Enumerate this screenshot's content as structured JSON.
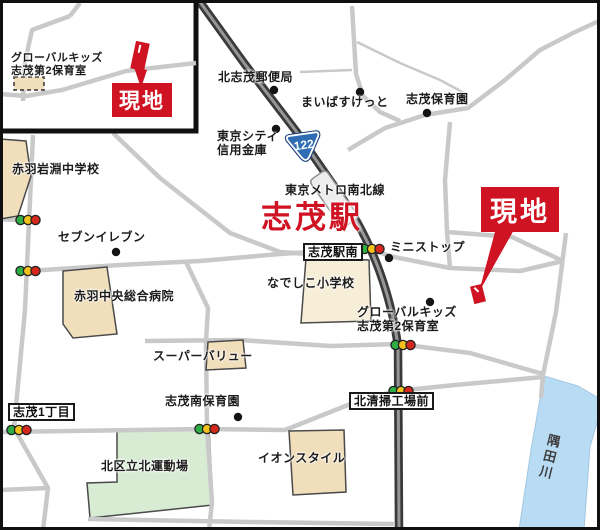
{
  "colors": {
    "accent-red": "#cf1322",
    "road-gray": "#c9c9c9",
    "rail-dark": "#3a3a3a",
    "rail-core": "#969696",
    "building-tan": "#f1deba",
    "building-cream": "#f7eed8",
    "park-green": "#d8ebd3",
    "river-blue": "#b9dcf5",
    "badge-blue": "#2f6cb3",
    "signal-green": "#2fae44",
    "signal-yellow": "#f3c11b",
    "signal-red": "#d4281c"
  },
  "station": {
    "line": "東京メトロ南北線",
    "name": "志茂駅"
  },
  "route": {
    "number": "122"
  },
  "site": {
    "label": "現地"
  },
  "river": {
    "name": "隅田川"
  },
  "pois": {
    "junior_high": "赤羽岩淵中学校",
    "post_office": "北志茂郵便局",
    "maibasuketto": "まいばすけっと",
    "shimo_nursery": "志茂保育園",
    "shinkin_line1": "東京シティ",
    "shinkin_line2": "信用金庫",
    "seven_eleven": "セブンイレブン",
    "ministop": "ミニストップ",
    "hospital": "赤羽中央総合病院",
    "elementary": "なでしこ小学校",
    "global_kids_line1": "グローバルキッズ",
    "global_kids_line2": "志茂第2保育室",
    "super_value": "スーパーバリュー",
    "minami_nursery": "志茂南保育園",
    "sports_ground": "北区立北運動場",
    "aeon_style": "イオンスタイル"
  },
  "signs": {
    "shimo_1chome": "志茂1丁目",
    "station_south": "志茂駅南",
    "cleaning_plant": "北清掃工場前"
  },
  "inset": {
    "poi_line1": "グローバルキッズ",
    "poi_line2": "志茂第2保育室",
    "site_label": "現地"
  },
  "icons": {
    "traffic_light": "traffic-light-icon",
    "poi_dot": "poi-dot-icon",
    "route_badge": "route-badge-icon",
    "station_marker": "station-marker-icon",
    "site_marker": "site-marker-icon"
  }
}
